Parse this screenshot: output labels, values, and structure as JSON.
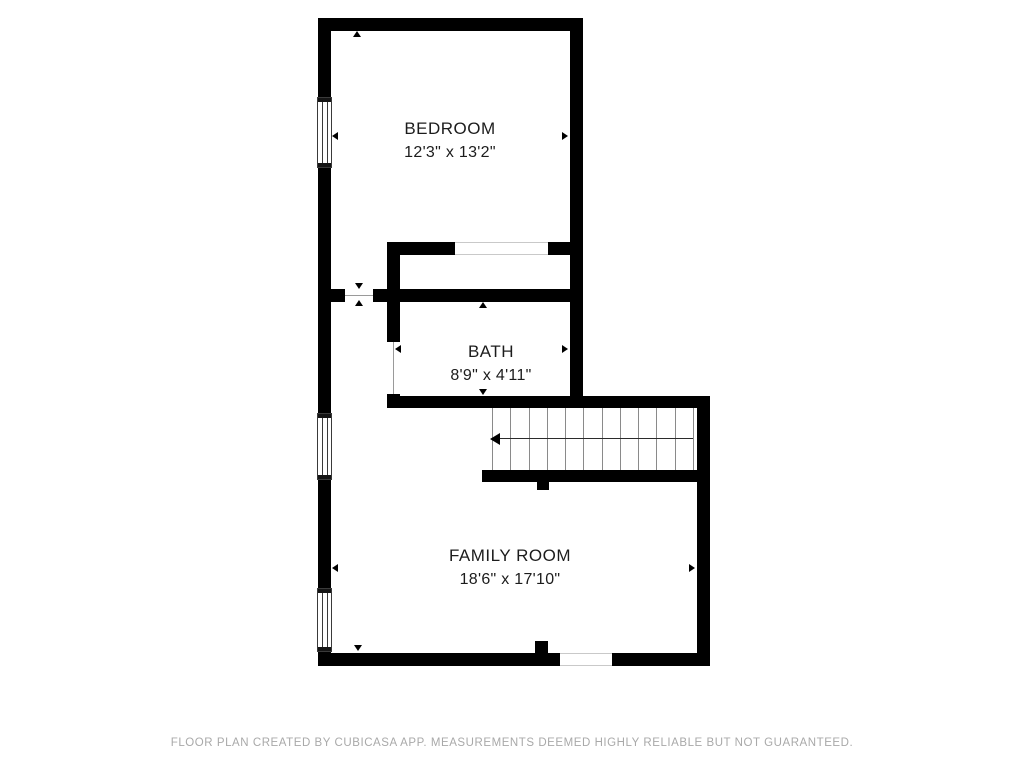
{
  "plan": {
    "rooms": [
      {
        "name": "BEDROOM",
        "dimensions": "12'3\" x 13'2\""
      },
      {
        "name": "BATH",
        "dimensions": "8'9\" x 4'11\""
      },
      {
        "name": "FAMILY ROOM",
        "dimensions": "18'6\" x 17'10\""
      }
    ],
    "stairs": {
      "step_line_count": 12,
      "direction": "left"
    },
    "colors": {
      "wall": "#000000",
      "background": "#ffffff",
      "label_text": "#1c1c1c",
      "footer_text": "#a9a9a9"
    }
  },
  "footer": {
    "disclaimer": "FLOOR PLAN CREATED BY CUBICASA APP. MEASUREMENTS DEEMED HIGHLY RELIABLE BUT NOT GUARANTEED."
  }
}
